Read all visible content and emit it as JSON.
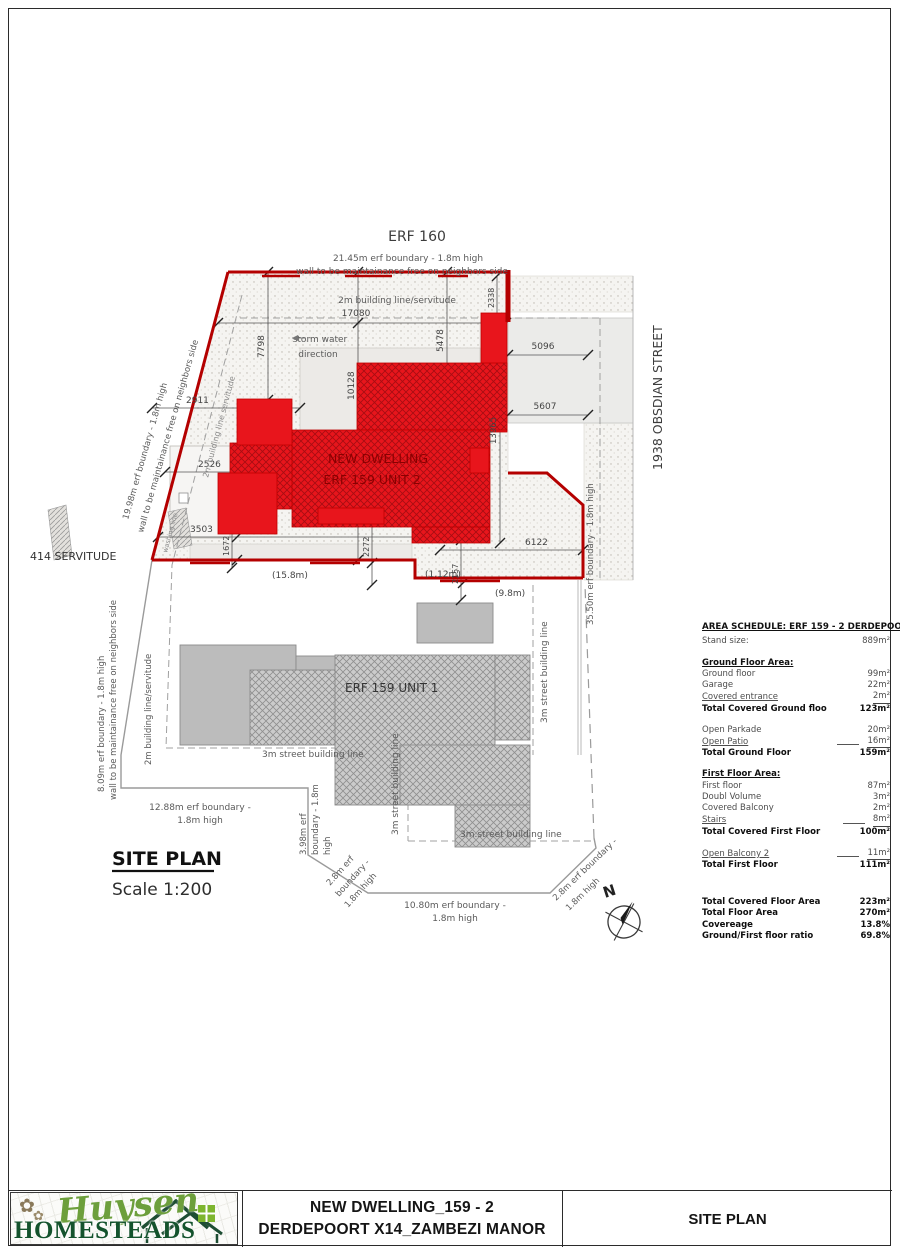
{
  "labels": {
    "erf160": "ERF 160",
    "boundary_top_1": "21.45m erf boundary - 1.8m high",
    "boundary_top_2": "wall to be maintainance free on neighbors side",
    "building_line_top": "2m building line/servitude",
    "storm_1": "storm water",
    "storm_2": "direction",
    "street": "1938 OBSDIAN STREET",
    "servitude": "414 SERVITUDE",
    "boundary_left_1": "19.98m erf boundary - 1.8m high",
    "boundary_left_2": "wall to be maintainance free on neighbors side",
    "building_line_slant": "2m building line servitude",
    "washing_line": "washing line",
    "unit2_line1": "NEW DWELLING",
    "unit2_line2": "ERF 159 UNIT 2",
    "unit1": "ERF 159 UNIT 1",
    "boundary_right": "35.50m erf boundary - 1.8m high",
    "boundary_left2_1": "8.09m erf boundary - 1.8m high",
    "boundary_left2_2": "wall to be maintainance free on neighbors side",
    "building_line_left2": "2m building line/servitude",
    "street_line": "3m street building line",
    "street_line_dot": "3m.street building line",
    "boundary_1288_1": "12.88m erf boundary -",
    "boundary_1288_2": "1.8m high",
    "boundary_398_1": "3.98m erf",
    "boundary_398_2": "boundary - 1.8m",
    "boundary_398_3": "high",
    "boundary_28l_1": "2.8m erf",
    "boundary_28l_2": "boundary -",
    "boundary_28l_3": "1.8m high",
    "boundary_1080_1": "10.80m erf boundary -",
    "boundary_1080_2": "1.8m high",
    "boundary_28r_1": "2.8m erf boundary -",
    "boundary_28r_2": "1.8m high",
    "site_plan": "SITE PLAN",
    "scale": "Scale 1:200",
    "north": "N"
  },
  "dims": {
    "d17080": "17080",
    "d7798": "7798",
    "d10128": "10128",
    "d5478": "5478",
    "d2338": "2338",
    "d5096": "5096",
    "d5607": "5607",
    "d13965": "13965",
    "d2911": "2911",
    "d2526": "2526",
    "d3503": "3503",
    "d1672": "1672",
    "d2272": "2272",
    "d2157": "2157",
    "d6122": "6122",
    "m158": "(15.8m)",
    "m112": "(1.12m)",
    "m98": "(9.8m)"
  },
  "area_schedule": {
    "title": "AREA SCHEDULE: ERF 159 - 2 DERDEPOORT X14:",
    "rows": [
      {
        "l": "Stand size:",
        "v": "889m²"
      },
      {
        "l": "Ground Floor Area:",
        "v": "",
        "sec": true,
        "gap": true
      },
      {
        "l": "Ground floor",
        "v": "99m²"
      },
      {
        "l": "Garage",
        "v": "22m²"
      },
      {
        "l": "Covered entrance",
        "v": "2m²",
        "ul": true
      },
      {
        "l": "Total Covered Ground floo",
        "v": "123m²",
        "bold": true
      },
      {
        "l": "Open Parkade",
        "v": "20m²",
        "gap": true
      },
      {
        "l": "Open Patio",
        "v": "16m²",
        "ul": true,
        "dash": true
      },
      {
        "l": "Total Ground Floor",
        "v": "159m²",
        "bold": true
      },
      {
        "l": "First Floor Area:",
        "v": "",
        "sec": true,
        "gap": true
      },
      {
        "l": "First floor",
        "v": "87m²"
      },
      {
        "l": "Doubl Volume",
        "v": "3m²"
      },
      {
        "l": "Covered Balcony",
        "v": "2m²"
      },
      {
        "l": "Stairs",
        "v": "8m²",
        "ul": true,
        "dash": true
      },
      {
        "l": "Total Covered First Floor",
        "v": "100m²",
        "bold": true
      },
      {
        "l": "Open Balcony 2",
        "v": "11m²",
        "ul": true,
        "dash": true,
        "gap": true
      },
      {
        "l": "Total First Floor",
        "v": "111m²",
        "bold": true
      },
      {
        "l": "Total Covered Floor Area",
        "v": "223m²",
        "bold": true,
        "gap2": true
      },
      {
        "l": "Total Floor Area",
        "v": "270m²",
        "bold": true
      },
      {
        "l": "Covereage",
        "v": "13.8%",
        "bold": true
      },
      {
        "l": "Ground/First floor ratio",
        "v": "69.8%",
        "bold": true
      }
    ]
  },
  "footer": {
    "logo_script": "Huysen",
    "logo_main": "HOMESTEADS",
    "flower": "✿",
    "title_line1": "NEW DWELLING_159 - 2",
    "title_line2": "DERDEPOORT X14_ZAMBEZI MANOR",
    "sheet": "SITE PLAN"
  },
  "colors": {
    "building_red": "#e8151c",
    "boundary_red": "#b40000",
    "logo_green": "#6d9f3c",
    "logo_dark_green": "#14532d"
  }
}
